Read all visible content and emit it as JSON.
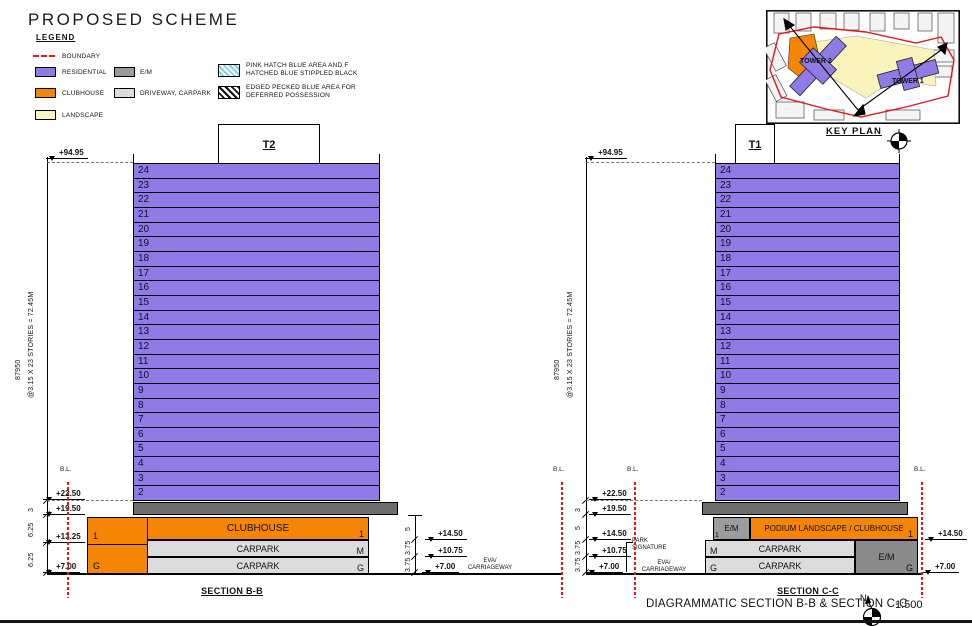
{
  "title": "PROPOSED SCHEME",
  "legend": {
    "heading": "LEGEND",
    "boundary": "BOUNDARY",
    "residential": "RESIDENTIAL",
    "clubhouse": "CLUBHOUSE",
    "landscape": "LANDSCAPE",
    "em": "E/M",
    "driveway": "DRIVEWAY, CARPARK",
    "hatch_blue_1": "PINK HATCH BLUE AREA AND F",
    "hatch_blue_2": "HATCHED BLUE STIPPLED BLACK",
    "hatch_black_1": "EDGED PECKED BLUE AREA FOR",
    "hatch_black_2": "DEFERRED POSSESSION"
  },
  "colors": {
    "residential": "#8f7ae6",
    "clubhouse": "#f58505",
    "landscape": "#faf5c0",
    "em": "#9c9c9c",
    "em_dark": "#6e6e6e",
    "carpark": "#dcdcdc",
    "boundary_red": "#e01818",
    "hatch_blue": "#7fd2ea"
  },
  "keyplan": {
    "label": "KEY PLAN",
    "tower1": "TOWER 1",
    "tower2": "TOWER 2"
  },
  "floors": [
    "24",
    "23",
    "22",
    "21",
    "20",
    "19",
    "18",
    "17",
    "16",
    "15",
    "14",
    "13",
    "12",
    "11",
    "10",
    "9",
    "8",
    "7",
    "6",
    "5",
    "4",
    "3",
    "2"
  ],
  "section_b": {
    "tower_label": "T2",
    "top_level": "+94.95",
    "dim_height": "87950",
    "dim_storeys": "@3.15 X 23 STORIES = 72.45M",
    "lv_2250": "+22.50",
    "lv_1950": "+19.50",
    "lv_1325": "+13.25",
    "lv_700": "+7.00",
    "dim_3": "3",
    "dim_625a": "6.25",
    "dim_625b": "6.25",
    "clubhouse": "CLUBHOUSE",
    "carpark_m": "CARPARK",
    "carpark_g": "CARPARK",
    "lbl_1_left": "1",
    "lbl_g_left": "G",
    "lbl_1_right": "1",
    "lbl_m_right": "M",
    "lbl_g_right": "G",
    "r_lv_1450": "+14.50",
    "r_lv_1075": "+10.75",
    "r_lv_700": "+7.00",
    "dim_5": "5",
    "dim_375a": "3.75",
    "dim_375b": "3.75",
    "eva_1": "EVA/",
    "eva_2": "CARRIAGEWAY",
    "bl_left": "B.L.",
    "bl_right": "B.L.",
    "label": "SECTION B-B"
  },
  "section_c": {
    "tower_label": "T1",
    "top_level": "+94.95",
    "dim_height": "87950",
    "dim_storeys": "@3.15 X 23 STORIES = 72.45M",
    "lv_2250": "+22.50",
    "lv_1950": "+19.50",
    "lv_1450": "+14.50",
    "lv_1075": "+10.75",
    "lv_700": "+7.00",
    "dim_3": "3",
    "dim_5": "5",
    "dim_375a": "3.75",
    "dim_375b": "3.75",
    "em_small": "E/M",
    "em_small_sub": "1",
    "podium": "PODIUM LANDSCAPE / CLUBHOUSE",
    "carpark_m": "CARPARK",
    "carpark_g": "CARPARK",
    "lbl_m_left": "M",
    "lbl_g_left": "G",
    "lbl_1_right": "1",
    "lbl_g_right": "G",
    "em_big": "E/M",
    "park_sig_1": "PARK",
    "park_sig_2": "SIGNATURE",
    "eva_1": "EVA/",
    "eva_2": "CARRIAGEWAY",
    "bl_left": "B.L.",
    "bl_right": "B.L.",
    "r_lv_1450": "+14.50",
    "r_lv_700": "+7.00",
    "label": "SECTION C-C"
  },
  "footer": {
    "title": "DIAGRAMMATIC SECTION B-B & SECTION C-C",
    "scale": "1:500",
    "north": "N"
  }
}
